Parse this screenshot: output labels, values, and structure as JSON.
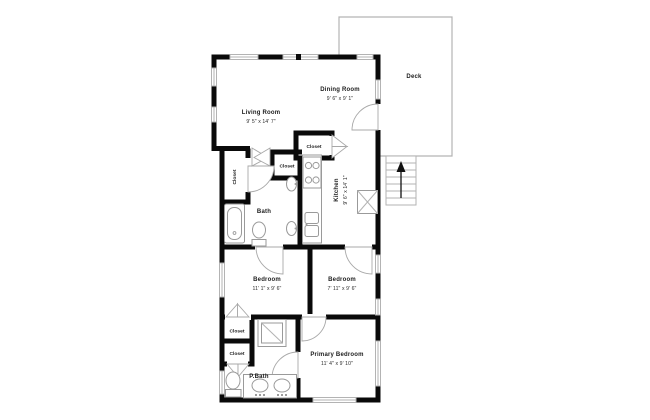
{
  "page": {
    "title": "Apartment floor plan",
    "background": "#ffffff"
  },
  "colors": {
    "wall": "#0a0a0a",
    "thin_line": "#b3b3b3",
    "fixture_line": "#9a9a9a",
    "label_text": "#1c1c1c"
  },
  "rooms": {
    "living_room": {
      "name": "Living Room",
      "dims": "9' 5\" x 14' 7\""
    },
    "dining_room": {
      "name": "Dining Room",
      "dims": "9' 6\" x 9' 1\""
    },
    "deck": {
      "name": "Deck"
    },
    "kitchen": {
      "name": "Kitchen",
      "dims": "9' 6\" x 14' 1\""
    },
    "bath": {
      "name": "Bath"
    },
    "hall_closet": {
      "name": "Closet"
    },
    "small_closet": {
      "name": "Closet"
    },
    "kitchen_closet": {
      "name": "Closet"
    },
    "bedroom_left": {
      "name": "Bedroom",
      "dims": "11' 1\" x 9' 6\""
    },
    "bedroom_right": {
      "name": "Bedroom",
      "dims": "7' 11\" x 9' 6\""
    },
    "primary_closet_1": {
      "name": "Closet"
    },
    "primary_closet_2": {
      "name": "Closet"
    },
    "primary_bath": {
      "name": "P.Bath"
    },
    "primary_bedroom": {
      "name": "Primary Bedroom",
      "dims": "11' 4\" x 9' 10\""
    }
  },
  "fixtures": [
    "stairs-up",
    "bathtub",
    "toilet",
    "pedestal-sink",
    "kitchen-counter",
    "stove",
    "kitchen-sink",
    "water-heater",
    "shower",
    "double-vanity"
  ]
}
